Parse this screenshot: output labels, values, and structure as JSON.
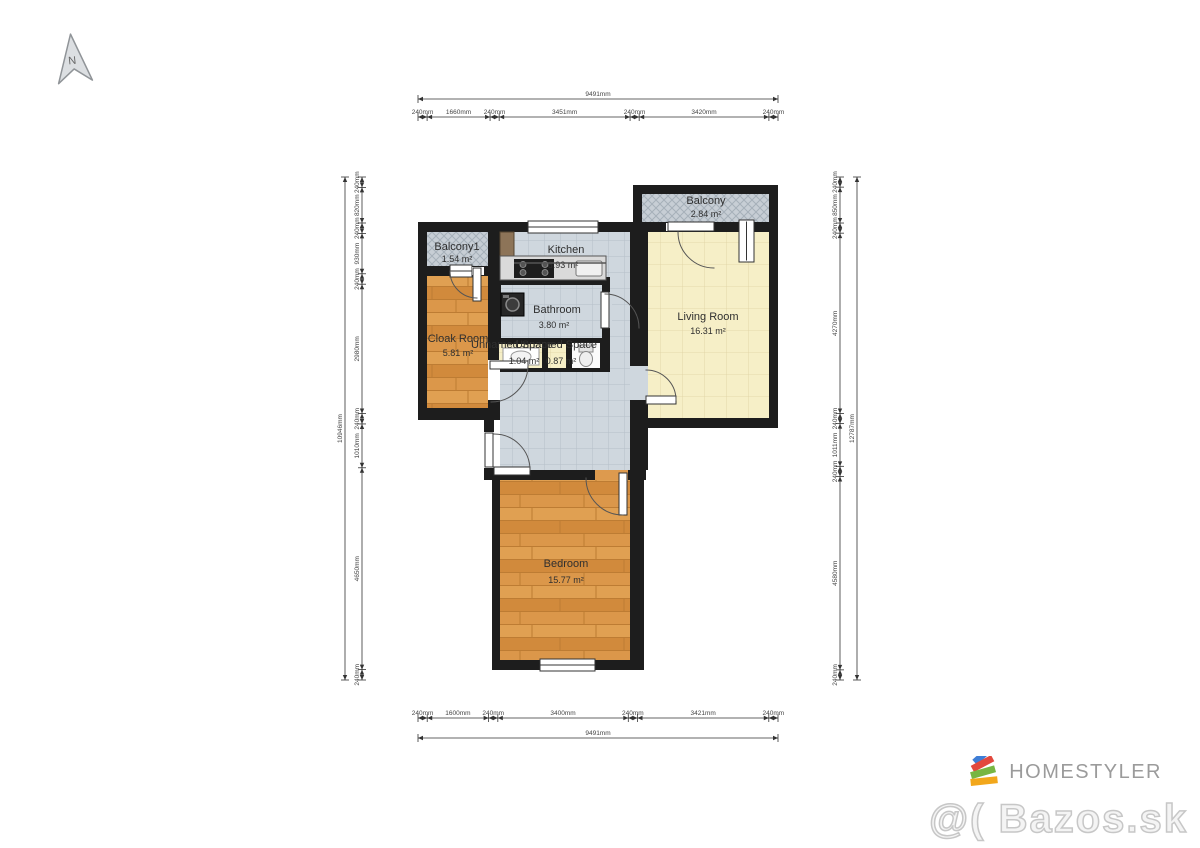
{
  "north": {
    "label": "N"
  },
  "rooms": {
    "balcony1": {
      "name": "Balcony1",
      "area": "1.54 m²"
    },
    "cloak": {
      "name": "Cloak Room",
      "area": "5.81 m²"
    },
    "kitchen": {
      "name": "Kitchen",
      "area": "6.93 m²"
    },
    "balcony": {
      "name": "Balcony",
      "area": "2.84 m²"
    },
    "living": {
      "name": "Living Room",
      "area": "16.31 m²"
    },
    "bathroom": {
      "name": "Bathroom",
      "area": "3.80 m²"
    },
    "unnamed1": {
      "name": "Unnamed Space",
      "area": "1.04 m²"
    },
    "unnamed2": {
      "name": "Unnamed Space",
      "area": "0.87 m²"
    },
    "bedroom": {
      "name": "Bedroom",
      "area": "15.77 m²"
    }
  },
  "dimensions": {
    "top": {
      "total": "9491mm",
      "segments": [
        "240mm",
        "1660mm",
        "240mm",
        "3451mm",
        "240mm",
        "3420mm",
        "240mm"
      ]
    },
    "bottom": {
      "total": "9491mm",
      "segments": [
        "240mm",
        "1600mm",
        "240mm",
        "3400mm",
        "240mm",
        "3421mm",
        "240mm"
      ]
    },
    "left": {
      "total": "10946mm",
      "segments": [
        "240mm",
        "820mm",
        "240mm",
        "930mm",
        "240mm",
        "2980mm",
        "240mm",
        "1010mm",
        "4650mm",
        "240mm"
      ]
    },
    "right": {
      "total": "12787mm",
      "segments": [
        "240mm",
        "850mm",
        "240mm",
        "4270mm",
        "240mm",
        "1011mm",
        "240mm",
        "4580mm",
        "240mm"
      ]
    }
  },
  "branding": {
    "logo_text": "HOMESTYLER",
    "watermark": "@( Bazos.sk"
  },
  "colors": {
    "wall": "#1d1d1d",
    "tile_floor": "#cfd7de",
    "living_floor": "#f6efc7",
    "wood_floor": "#dd9a4e",
    "balcony_hatch": "#c7ced5",
    "logo_blue": "#3f7ed6",
    "logo_red": "#e2483d",
    "logo_green": "#78b642",
    "logo_yellow": "#f2a71b"
  }
}
